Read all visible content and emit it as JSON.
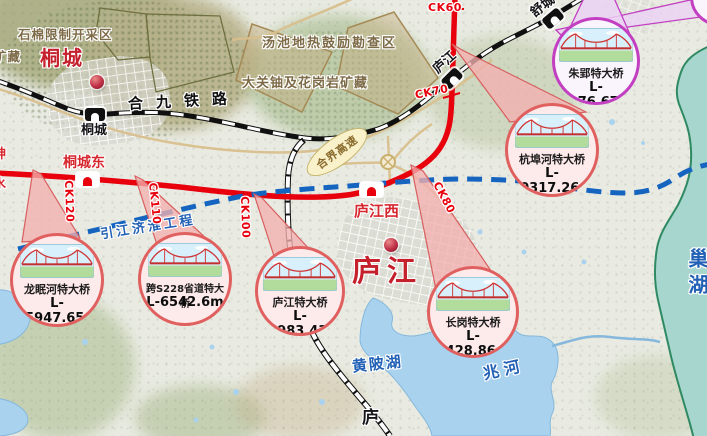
{
  "labels": {
    "city_tongcheng": "桐城",
    "city_lujiang": "庐江",
    "station_tongcheng": "桐城",
    "station_tongchengdong": "桐城东",
    "station_lujiangxi": "庐江西",
    "station_lujiang": "庐江",
    "station_shucheng": "舒城",
    "railway_hejiu": "合九铁路",
    "expressway_hejie": "合界高速",
    "project_yinjiangjihuai": "引江济淮工程",
    "area_shimian": "石棉限制开采区",
    "area_kuangcang": "矿藏",
    "area_tangchi": "汤池地热鼓励勘查区",
    "area_daguan": "大关铀及花岗岩矿藏",
    "lake_huangpi": "黄陂湖",
    "river_zhaohe": "兆河",
    "lake_chaohu": "巢湖",
    "partial_left_top": "神",
    "partial_left_bottom": "水",
    "partial_bottom": "庐"
  },
  "mileage": {
    "ck60": "CK60",
    "ck70": "CK70",
    "ck80": "CK80",
    "ck100": "CK100",
    "ck110": "CK110",
    "ck120": "CK120"
  },
  "bridges": [
    {
      "name": "龙眠河特大桥",
      "length": "L-15947.65m"
    },
    {
      "name": "跨S228省道特大桥",
      "length": "L-6542.6m"
    },
    {
      "name": "庐江特大桥",
      "length": "L-20983.43m"
    },
    {
      "name": "长岗特大桥",
      "length": "L-5428.86m"
    },
    {
      "name": "杭埠河特大桥",
      "length": "L-20317.26m"
    },
    {
      "name": "朱郢特大桥",
      "length": "L-1076.67m"
    }
  ],
  "colors": {
    "new_rail_line": "#e8000d",
    "water_project_line": "#1565c0",
    "callout_red_border": "#e06060",
    "callout_purple_border": "#c23fc2",
    "water": "#a9d2ee",
    "chaohu_water": "#a6d6cd",
    "boundary_green": "#2f8a63"
  }
}
